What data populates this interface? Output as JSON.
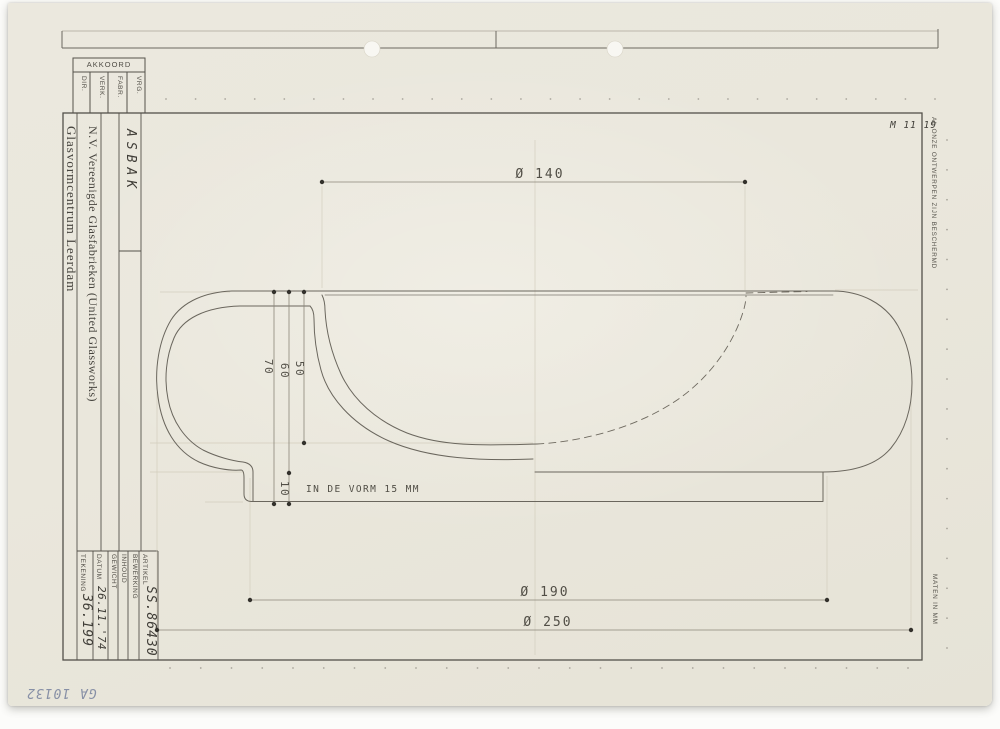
{
  "stamp_table": {
    "header": "AKKOORD",
    "columns": [
      {
        "label": "DIR."
      },
      {
        "label": "VERK."
      },
      {
        "label": "FABR."
      },
      {
        "label": "VRG."
      }
    ]
  },
  "title_block": {
    "company_main": "N.V. Vereenigde Glasfabrieken (United Glassworks)",
    "company_sub": "Glasvormcentrum Leerdam",
    "product": "ASBAK",
    "fields": [
      {
        "label": "TEKENING",
        "value": "36.199"
      },
      {
        "label": "DATUM",
        "value": "26.11.'74"
      },
      {
        "label": "GEWICHT",
        "value": ""
      },
      {
        "label": "INHOUD",
        "value": ""
      },
      {
        "label": "BEWERKING",
        "value": ""
      },
      {
        "label": "ARTIKEL",
        "value": "SS.86430"
      }
    ]
  },
  "margin_notes": {
    "right_top": "AL ONZE ONTWERPEN ZIJN BESCHERMD",
    "right_bottom": "MATEN IN MM"
  },
  "annotations": {
    "top_right_code": "M 11 19",
    "bottom_left_code": "GA 10132"
  },
  "drawing": {
    "dim_opening": "Ø 140",
    "dim_base": "Ø 190",
    "dim_overall": "Ø 250",
    "dim_height_total": "70",
    "dim_height_wall": "60",
    "dim_depth": "50",
    "dim_base_height": "10",
    "note": "IN DE VORM 15 MM"
  },
  "colors": {
    "paper": "#eae7dc",
    "ink": "#55524b",
    "outline": "#6a665d",
    "dimension": "#8b8679",
    "guide": "#cfc9b8",
    "pencil_blue": "#8790a6"
  }
}
